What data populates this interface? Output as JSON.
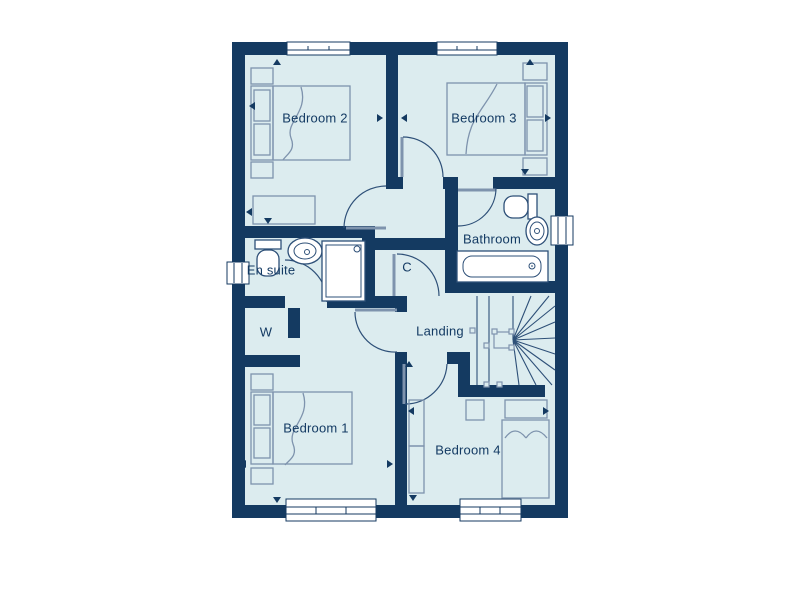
{
  "title": "floor-plan",
  "colors": {
    "wall": "#143a61",
    "floor": "#dcecef",
    "furniture_line": "#7e93ad",
    "fixture_line": "#2e5078",
    "text": "#133a63",
    "window_fill": "#ffffff"
  },
  "rooms": {
    "bedroom2": {
      "label": "Bedroom 2"
    },
    "bedroom3": {
      "label": "Bedroom 3"
    },
    "bathroom": {
      "label": "Bathroom"
    },
    "en_suite": {
      "label": "En suite"
    },
    "cupboard": {
      "label": "C"
    },
    "wardrobe": {
      "label": "W"
    },
    "landing": {
      "label": "Landing"
    },
    "bedroom1": {
      "label": "Bedroom 1"
    },
    "bedroom4": {
      "label": "Bedroom 4"
    }
  }
}
